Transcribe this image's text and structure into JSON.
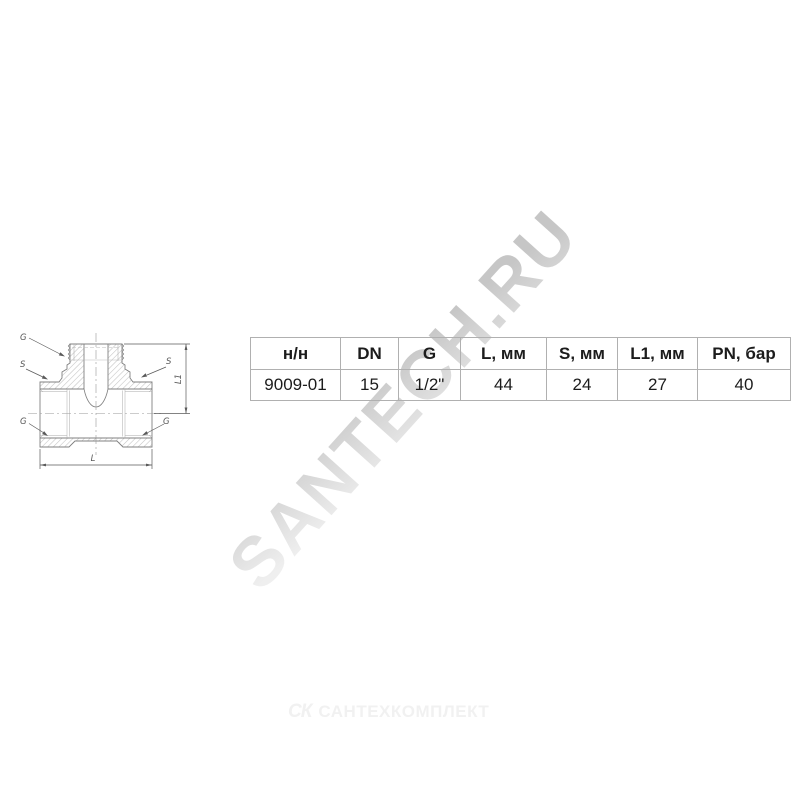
{
  "watermark": {
    "text": "SANTECH.RU"
  },
  "footer": {
    "mark": "СК",
    "brand": "САНТЕХКОМПЛЕКТ"
  },
  "drawing": {
    "labels": {
      "g_top": "G",
      "s_left": "S",
      "s_right": "S",
      "g_bottom_left": "G",
      "g_bottom_right": "G",
      "l1": "L1",
      "l": "L"
    }
  },
  "table": {
    "headers": [
      "н/н",
      "DN",
      "G",
      "L, мм",
      "S, мм",
      "L1, мм",
      "PN, бар"
    ],
    "row": [
      "9009-01",
      "15",
      "1/2\"",
      "44",
      "24",
      "27",
      "40"
    ]
  },
  "colors": {
    "table_border": "#b0b0b0",
    "text": "#1c1c1c",
    "drawing_stroke": "#808080",
    "hatch": "#c2c2c2",
    "watermark": "#d7d7d7",
    "footer": "#f1f1f1"
  }
}
